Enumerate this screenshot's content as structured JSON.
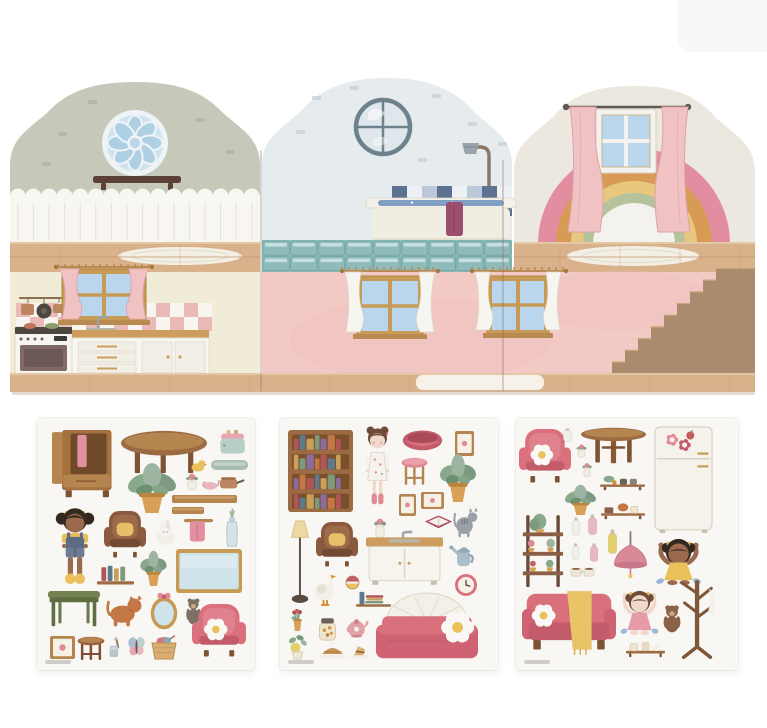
{
  "canvas": {
    "width": 767,
    "height": 728
  },
  "palette": {
    "stone": "#c6c9ba",
    "stoneBrick": "#a9ad9c",
    "plankBand": "#f7f6f0",
    "plankLine": "#e5e2d8",
    "domeMid": "#e6ebee",
    "brickMid": "#c3ccd4",
    "portRing": "#6e828d",
    "domeRight": "#ece7df",
    "wood": "#d9b28c",
    "woodLine": "#c0946c",
    "creamWall": "#f0ecd7",
    "pinkWall": "#f2c9c5",
    "pinkWallDeep": "#eebdb9",
    "frameTan": "#c79b55",
    "paneBlue": "#b9d6ec",
    "pinkCurtain": "#f1c2c4",
    "pinkCurtainDk": "#e0a2a6",
    "whiteCurtain": "#f7f5f0",
    "checkerPink": "#e9bab6",
    "stoveWhite": "#f6f4ee",
    "ovenDoor": "#806a68",
    "counterWood": "#cc9d5e",
    "cabinetWhite": "#f8f6f0",
    "copper": "#bd8663",
    "tileNavy": "#5d7191",
    "tileLight": "#bac8da",
    "tileWhite": "#edf0f4",
    "tub": "#f0ede3",
    "water": "#7f9ec2",
    "towelPlum": "#9c4e6e",
    "teal": "#8fbcba",
    "tealLight": "#cfe5e4",
    "tealDark": "#6fa39f",
    "stairBlock": "#ab8b6d",
    "stairTread": "#c9a87f",
    "rainbowPink": "#e28da0",
    "rainbowOchre": "#d89b55",
    "rainbowYellow": "#e8c87e",
    "rainbowSage": "#b5c39c",
    "rainbowCore": "#f4f2ec",
    "rodDark": "#5f5a56",
    "sheetBg": "#f8f7f4",
    "rug": "#f4efe5"
  },
  "house": {
    "panels": [
      {
        "name": "kitchen-panel",
        "upper": "stone-gable-with-rosette-window-and-shelf",
        "lower": "kitchen-with-window-stove-and-cabinets"
      },
      {
        "name": "bathroom-panel",
        "upper": "bathroom-with-porthole-window-shower-and-tub",
        "lower": "pink-room-with-two-curtained-windows"
      },
      {
        "name": "bedroom-panel",
        "upper": "rainbow-behind-curtained-window",
        "lower": "pink-room-with-wooden-staircase"
      }
    ]
  },
  "sheets": [
    {
      "name": "sticker-sheet-1",
      "theme": "living-room-furniture",
      "x": 37,
      "y": 418,
      "w": 218,
      "h": 252,
      "items": [
        {
          "n": "open-wardrobe",
          "t": "wardrobe",
          "x": 15,
          "y": 12,
          "w": 62,
          "h": 70
        },
        {
          "n": "coffee-table",
          "t": "tableOval",
          "x": 84,
          "y": 12,
          "w": 86,
          "h": 44
        },
        {
          "n": "toaster",
          "t": "toaster",
          "x": 182,
          "y": 12,
          "w": 27,
          "h": 25
        },
        {
          "n": "serving-tray",
          "t": "tray",
          "x": 174,
          "y": 42,
          "w": 37,
          "h": 10
        },
        {
          "n": "potted-plant-large",
          "t": "plant",
          "x": 88,
          "y": 47,
          "w": 54,
          "h": 48
        },
        {
          "n": "rubber-duck",
          "t": "duck",
          "x": 154,
          "y": 42,
          "w": 15,
          "h": 12
        },
        {
          "n": "potted-herb",
          "t": "flowercup",
          "x": 147,
          "y": 55,
          "w": 16,
          "h": 18
        },
        {
          "n": "toy-mouse",
          "t": "mouse",
          "x": 164,
          "y": 62,
          "w": 18,
          "h": 10
        },
        {
          "n": "cooking-pot",
          "t": "pot",
          "x": 183,
          "y": 56,
          "w": 24,
          "h": 16
        },
        {
          "n": "wall-shelf-long",
          "t": "plank",
          "x": 135,
          "y": 77,
          "w": 65,
          "h": 8
        },
        {
          "n": "wall-shelf-short",
          "t": "plank",
          "x": 135,
          "y": 89,
          "w": 32,
          "h": 7
        },
        {
          "n": "doll-girl-overalls",
          "t": "dollA",
          "x": 18,
          "y": 90,
          "w": 40,
          "h": 76
        },
        {
          "n": "wingback-chair-brown",
          "t": "chair",
          "v": "brown",
          "x": 67,
          "y": 93,
          "w": 42,
          "h": 47
        },
        {
          "n": "bunny",
          "t": "bunny",
          "x": 117,
          "y": 102,
          "w": 23,
          "h": 25
        },
        {
          "n": "towel-on-rail",
          "t": "towelrail",
          "x": 147,
          "y": 101,
          "w": 29,
          "h": 23
        },
        {
          "n": "flower-vase",
          "t": "vase",
          "x": 184,
          "y": 88,
          "w": 22,
          "h": 42
        },
        {
          "n": "notice-board",
          "t": "board",
          "x": 139,
          "y": 131,
          "w": 66,
          "h": 44
        },
        {
          "n": "book-shelf",
          "t": "shelfbooks",
          "v": "v",
          "x": 60,
          "y": 146,
          "w": 37,
          "h": 22
        },
        {
          "n": "potted-plant-small",
          "t": "plant",
          "x": 102,
          "y": 134,
          "w": 29,
          "h": 34
        },
        {
          "n": "green-desk",
          "t": "desk",
          "x": 11,
          "y": 173,
          "w": 52,
          "h": 36
        },
        {
          "n": "cat-orange",
          "t": "cat",
          "v": "orange",
          "x": 70,
          "y": 177,
          "w": 37,
          "h": 32
        },
        {
          "n": "oval-mirror",
          "t": "mirror",
          "x": 112,
          "y": 174,
          "w": 30,
          "h": 38
        },
        {
          "n": "teddy-bear-gray",
          "t": "teddy",
          "v": "gray",
          "x": 147,
          "y": 179,
          "w": 19,
          "h": 28
        },
        {
          "n": "armchair-pink",
          "t": "chair",
          "v": "pink",
          "x": 155,
          "y": 186,
          "w": 54,
          "h": 53
        },
        {
          "n": "picture-frame",
          "t": "frame",
          "x": 13,
          "y": 218,
          "w": 25,
          "h": 23
        },
        {
          "n": "stool-brown",
          "t": "stool",
          "v": "brown",
          "x": 40,
          "y": 218,
          "w": 28,
          "h": 25
        },
        {
          "n": "cup-with-brush",
          "t": "cupbrush",
          "x": 71,
          "y": 219,
          "w": 14,
          "h": 21
        },
        {
          "n": "butterfly",
          "t": "butterfly",
          "x": 90,
          "y": 218,
          "w": 19,
          "h": 22
        },
        {
          "n": "knitting-basket",
          "t": "basket",
          "x": 112,
          "y": 216,
          "w": 30,
          "h": 25
        }
      ]
    },
    {
      "name": "sticker-sheet-2",
      "theme": "bedroom-and-bath-furniture",
      "x": 280,
      "y": 418,
      "w": 218,
      "h": 252,
      "items": [
        {
          "n": "bookcase",
          "t": "bookcase",
          "x": 8,
          "y": 12,
          "w": 65,
          "h": 82
        },
        {
          "n": "doll-girl-dress",
          "t": "dollB",
          "x": 80,
          "y": 8,
          "w": 35,
          "h": 80
        },
        {
          "n": "pet-basket",
          "t": "petbed",
          "x": 122,
          "y": 11,
          "w": 41,
          "h": 22
        },
        {
          "n": "picture-frame",
          "t": "frame",
          "x": 175,
          "y": 13,
          "w": 19,
          "h": 25
        },
        {
          "n": "stool-pink",
          "t": "stool",
          "v": "pink",
          "x": 121,
          "y": 39,
          "w": 27,
          "h": 29
        },
        {
          "n": "potted-plant-large",
          "t": "plant",
          "x": 158,
          "y": 38,
          "w": 40,
          "h": 46
        },
        {
          "n": "picture-frame-small",
          "t": "frame",
          "x": 119,
          "y": 76,
          "w": 17,
          "h": 22
        },
        {
          "n": "picture-frame-wide",
          "t": "frame",
          "x": 141,
          "y": 74,
          "w": 23,
          "h": 17
        },
        {
          "n": "open-book",
          "t": "openbook",
          "x": 144,
          "y": 96,
          "w": 29,
          "h": 15
        },
        {
          "n": "cat-gray",
          "t": "cat",
          "v": "gray",
          "x": 174,
          "y": 89,
          "w": 25,
          "h": 31
        },
        {
          "n": "floor-lamp",
          "t": "lampfloor",
          "x": 8,
          "y": 103,
          "w": 24,
          "h": 82
        },
        {
          "n": "wingback-chair-brown",
          "t": "chair",
          "v": "brown",
          "x": 36,
          "y": 104,
          "w": 42,
          "h": 45
        },
        {
          "n": "potted-herb",
          "t": "flowercup",
          "x": 92,
          "y": 99,
          "w": 16,
          "h": 22
        },
        {
          "n": "sink-cabinet",
          "t": "sink",
          "x": 86,
          "y": 114,
          "w": 77,
          "h": 54
        },
        {
          "n": "watering-can",
          "t": "wateringcan",
          "x": 169,
          "y": 126,
          "w": 27,
          "h": 24
        },
        {
          "n": "wall-clock",
          "t": "clock",
          "x": 174,
          "y": 156,
          "w": 24,
          "h": 22
        },
        {
          "n": "goose",
          "t": "goose",
          "x": 34,
          "y": 154,
          "w": 25,
          "h": 34
        },
        {
          "n": "toy-ball",
          "t": "ball",
          "x": 66,
          "y": 158,
          "w": 13,
          "h": 13
        },
        {
          "n": "shelf-with-books",
          "t": "shelfbooks",
          "v": "h",
          "x": 76,
          "y": 173,
          "w": 35,
          "h": 17
        },
        {
          "n": "potted-flowers",
          "t": "flowers",
          "x": 8,
          "y": 191,
          "w": 19,
          "h": 22
        },
        {
          "n": "storage-jar",
          "t": "jar",
          "x": 37,
          "y": 199,
          "w": 21,
          "h": 24
        },
        {
          "n": "teapot",
          "t": "teapot",
          "x": 66,
          "y": 198,
          "w": 25,
          "h": 22
        },
        {
          "n": "bed",
          "t": "bed",
          "x": 96,
          "y": 173,
          "w": 102,
          "h": 70
        },
        {
          "n": "lemon-plant",
          "t": "lemon",
          "x": 5,
          "y": 216,
          "w": 25,
          "h": 25
        },
        {
          "n": "pie",
          "t": "pie",
          "x": 39,
          "y": 223,
          "w": 27,
          "h": 18
        },
        {
          "n": "cake-slice",
          "t": "cake",
          "x": 69,
          "y": 226,
          "w": 20,
          "h": 15
        }
      ]
    },
    {
      "name": "sticker-sheet-3",
      "theme": "kitchen-and-lounge-furniture",
      "x": 516,
      "y": 418,
      "w": 222,
      "h": 252,
      "items": [
        {
          "n": "armchair-pink",
          "t": "chair",
          "v": "pink",
          "x": 3,
          "y": 11,
          "w": 52,
          "h": 54
        },
        {
          "n": "vase-white",
          "t": "bottle",
          "v": "white",
          "x": 46,
          "y": 10,
          "w": 11,
          "h": 14
        },
        {
          "n": "dining-table",
          "t": "tableRound",
          "x": 65,
          "y": 9,
          "w": 65,
          "h": 37
        },
        {
          "n": "fridge",
          "t": "fridge",
          "x": 139,
          "y": 9,
          "w": 57,
          "h": 106
        },
        {
          "n": "plant-cup",
          "t": "flowercup",
          "x": 59,
          "y": 26,
          "w": 13,
          "h": 14
        },
        {
          "n": "flower-cup",
          "t": "flowercup",
          "x": 65,
          "y": 44,
          "w": 12,
          "h": 16
        },
        {
          "n": "shelf-plant-jars",
          "t": "shelfmisc",
          "v": "jars",
          "x": 84,
          "y": 56,
          "w": 45,
          "h": 17
        },
        {
          "n": "plant-in-basket",
          "t": "plant",
          "x": 47,
          "y": 68,
          "w": 35,
          "h": 29
        },
        {
          "n": "shelf-with-decor",
          "t": "shelfmisc",
          "v": "decor",
          "x": 85,
          "y": 84,
          "w": 44,
          "h": 18
        },
        {
          "n": "ladder-plant-shelf",
          "t": "ladder",
          "x": 6,
          "y": 91,
          "w": 42,
          "h": 78
        },
        {
          "n": "bottle-white",
          "t": "bottle",
          "v": "white",
          "x": 55,
          "y": 99,
          "w": 10,
          "h": 19
        },
        {
          "n": "bottle-pink",
          "t": "bottle",
          "v": "pink",
          "x": 71,
          "y": 96,
          "w": 11,
          "h": 21
        },
        {
          "n": "bottle-small-white",
          "t": "bottle",
          "v": "white",
          "x": 55,
          "y": 125,
          "w": 9,
          "h": 17
        },
        {
          "n": "bottle-small-pink",
          "t": "bottle",
          "v": "pink",
          "x": 73,
          "y": 125,
          "w": 10,
          "h": 19
        },
        {
          "n": "bottle-yellow",
          "t": "bottle",
          "v": "yellow",
          "x": 91,
          "y": 111,
          "w": 11,
          "h": 25
        },
        {
          "n": "tea-cups",
          "t": "cups",
          "x": 55,
          "y": 147,
          "w": 25,
          "h": 13
        },
        {
          "n": "pendant-lamp",
          "t": "pendant",
          "x": 97,
          "y": 114,
          "w": 35,
          "h": 50
        },
        {
          "n": "doll-girl-yellow",
          "t": "girlup",
          "v": "yellow",
          "x": 137,
          "y": 119,
          "w": 51,
          "h": 49
        },
        {
          "n": "coat-rack",
          "t": "coatrack",
          "x": 160,
          "y": 159,
          "w": 43,
          "h": 81
        },
        {
          "n": "sofa",
          "t": "sofa",
          "x": 6,
          "y": 169,
          "w": 94,
          "h": 68
        },
        {
          "n": "doll-girl-pink",
          "t": "girlup",
          "v": "pink",
          "x": 102,
          "y": 169,
          "w": 43,
          "h": 49
        },
        {
          "n": "teddy-bear-brown",
          "t": "teddy",
          "v": "brown",
          "x": 145,
          "y": 186,
          "w": 22,
          "h": 29
        },
        {
          "n": "shelf-with-jars",
          "t": "shelfmisc",
          "v": "jars2",
          "x": 110,
          "y": 221,
          "w": 39,
          "h": 19
        }
      ]
    }
  ]
}
